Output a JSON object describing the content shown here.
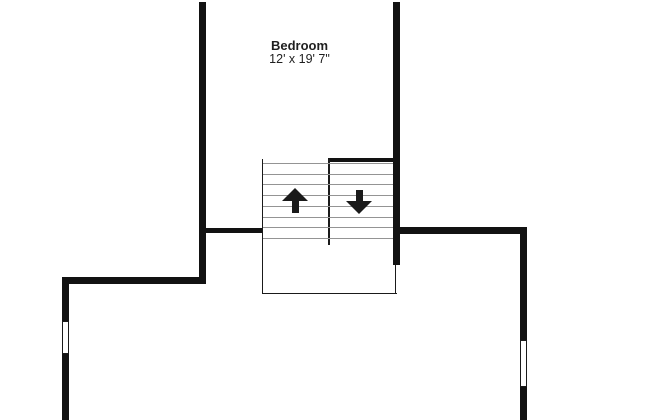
{
  "room": {
    "name": "Bedroom",
    "dimensions": "12' x 19' 7\""
  },
  "stairs": {
    "tread_count": 8,
    "up_icon": "arrow-up",
    "down_icon": "arrow-down"
  },
  "windows": {
    "count": 2
  },
  "colors": {
    "wall": "#121212",
    "thin_line": "#1a1a1a",
    "tread": "#949494",
    "text": "#1f1f1f",
    "background": "#ffffff"
  }
}
